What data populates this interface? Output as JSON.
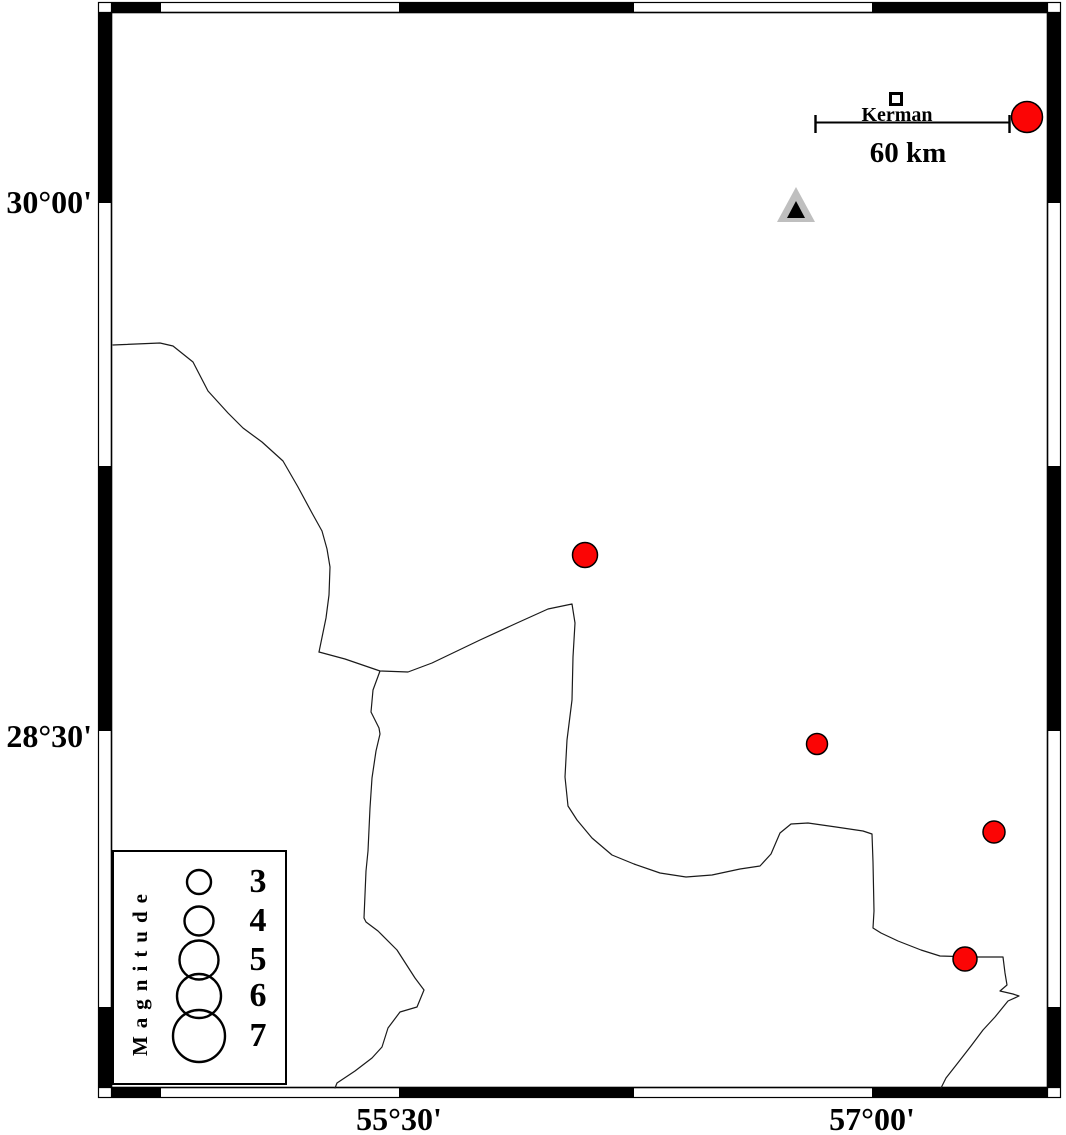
{
  "frame": {
    "lat_labels": [
      {
        "label": "30°00'",
        "y_px": 203
      },
      {
        "label": "28°30'",
        "y_px": 731
      }
    ],
    "lon_labels": [
      {
        "label": "55°30'",
        "x_px": 399
      },
      {
        "label": "57°00'",
        "x_px": 872
      }
    ]
  },
  "scale_bar": {
    "label": "60 km",
    "length_px": 195
  },
  "city": {
    "name": "Kerman",
    "x": 896,
    "y": 99
  },
  "station": {
    "marker": "triangle",
    "x": 796,
    "y": 207
  },
  "legend": {
    "title": "Magnitude",
    "entries": [
      {
        "label": "3",
        "diameter_px": 24
      },
      {
        "label": "4",
        "diameter_px": 29
      },
      {
        "label": "5",
        "diameter_px": 39
      },
      {
        "label": "6",
        "diameter_px": 44
      },
      {
        "label": "7",
        "diameter_px": 52
      }
    ]
  },
  "earthquakes": [
    {
      "x": 1027,
      "y": 117,
      "diameter_px": 31,
      "approx_lon": 57.49,
      "approx_lat": 30.24
    },
    {
      "x": 585,
      "y": 555,
      "diameter_px": 25,
      "approx_lon": 56.09,
      "approx_lat": 29.0
    },
    {
      "x": 817,
      "y": 744,
      "diameter_px": 21,
      "approx_lon": 56.83,
      "approx_lat": 28.46
    },
    {
      "x": 994,
      "y": 832,
      "diameter_px": 22,
      "approx_lon": 57.39,
      "approx_lat": 28.21
    },
    {
      "x": 965,
      "y": 959,
      "diameter_px": 24,
      "approx_lon": 57.29,
      "approx_lat": 27.85
    }
  ],
  "colors": {
    "earthquake_fill": "#fb0505",
    "station_fill": "#bfbfbf",
    "station_inner": "#000000",
    "frame": "#000000",
    "boundary_line": "#1a1a1a"
  }
}
